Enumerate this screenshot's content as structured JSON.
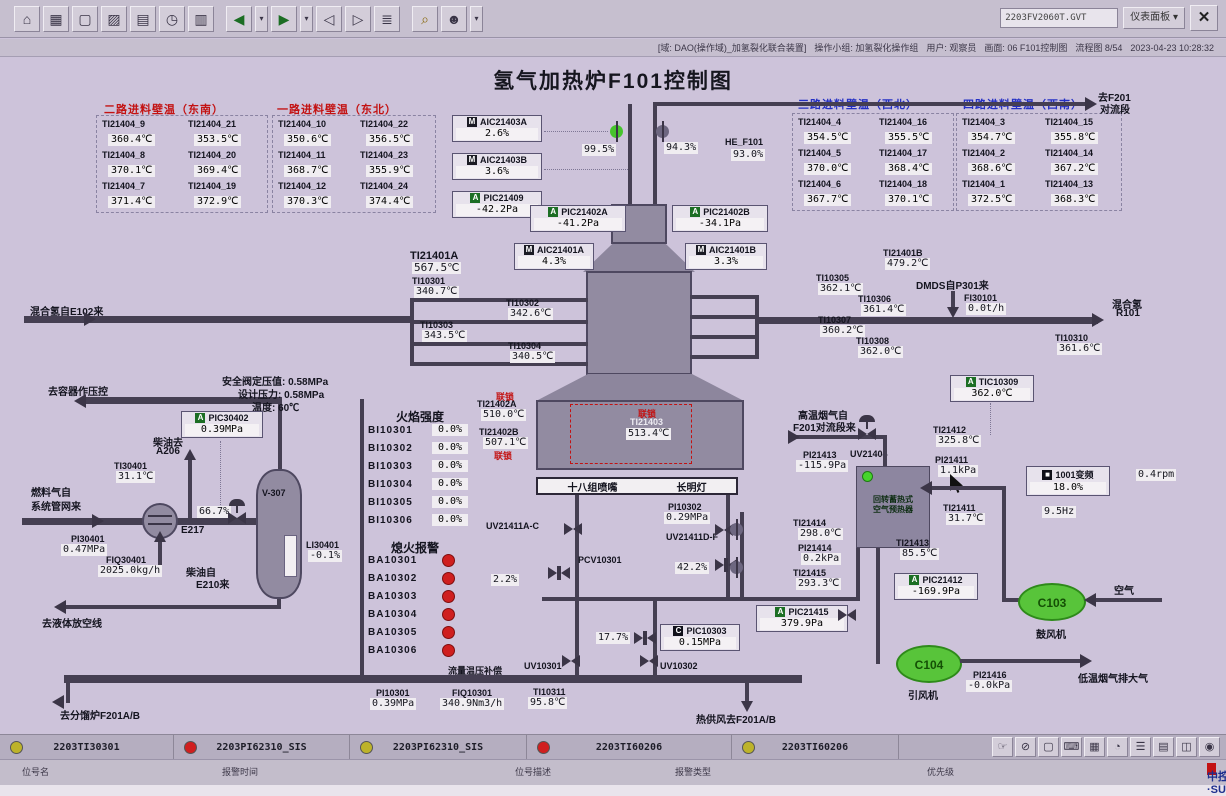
{
  "window": {
    "doc_selector": "2203FV2060T.GVT",
    "panel_button": "仪表面板 ▾",
    "status": {
      "domain": "[域: DAO(操作域)_加氢裂化联合装置]",
      "group": "操作小组: 加氢裂化操作组",
      "user": "用户: 观察员",
      "screen": "画面: 06 F101控制图",
      "flow": "流程图 8/54",
      "datetime": "2023-04-23 10:28:32"
    }
  },
  "title": "氢气加热炉F101控制图",
  "toolbar_icons": [
    {
      "name": "home",
      "glyph": "⌂"
    },
    {
      "name": "overview",
      "glyph": "▦"
    },
    {
      "name": "screen",
      "glyph": "▢"
    },
    {
      "name": "trend",
      "glyph": "▨"
    },
    {
      "name": "group",
      "glyph": "▤"
    },
    {
      "name": "history",
      "glyph": "◷"
    },
    {
      "name": "report",
      "glyph": "▥"
    },
    {
      "name": "back",
      "glyph": "◀"
    },
    {
      "name": "back-menu",
      "glyph": "▾"
    },
    {
      "name": "forward",
      "glyph": "▶"
    },
    {
      "name": "forward-menu",
      "glyph": "▾"
    },
    {
      "name": "page-prev",
      "glyph": "◁"
    },
    {
      "name": "page-next",
      "glyph": "▷"
    },
    {
      "name": "book",
      "glyph": "≣"
    },
    {
      "name": "search",
      "glyph": "⌕"
    },
    {
      "name": "user",
      "glyph": "☻"
    },
    {
      "name": "user-menu",
      "glyph": "▾"
    }
  ],
  "wall_panels": [
    {
      "title": "二路进料壁温（东南）",
      "items": [
        {
          "t": "TI21404_9",
          "v": "360.4℃"
        },
        {
          "t": "TI21404_21",
          "v": "353.5℃"
        },
        {
          "t": "TI21404_8",
          "v": "370.1℃"
        },
        {
          "t": "TI21404_20",
          "v": "369.4℃"
        },
        {
          "t": "TI21404_7",
          "v": "371.4℃"
        },
        {
          "t": "TI21404_19",
          "v": "372.9℃"
        }
      ]
    },
    {
      "title": "一路进料壁温（东北）",
      "items": [
        {
          "t": "TI21404_10",
          "v": "350.6℃"
        },
        {
          "t": "TI21404_22",
          "v": "356.5℃"
        },
        {
          "t": "TI21404_11",
          "v": "368.7℃"
        },
        {
          "t": "TI21404_23",
          "v": "355.9℃"
        },
        {
          "t": "TI21404_12",
          "v": "370.3℃"
        },
        {
          "t": "TI21404_24",
          "v": "374.4℃"
        }
      ]
    },
    {
      "title": "三路进料壁温（西北）",
      "items": [
        {
          "t": "TI21404_4",
          "v": "354.5℃"
        },
        {
          "t": "TI21404_16",
          "v": "355.5℃"
        },
        {
          "t": "TI21404_5",
          "v": "370.0℃"
        },
        {
          "t": "TI21404_17",
          "v": "368.4℃"
        },
        {
          "t": "TI21404_6",
          "v": "367.7℃"
        },
        {
          "t": "TI21404_18",
          "v": "370.1℃"
        }
      ]
    },
    {
      "title": "四路进料壁温（西南）",
      "items": [
        {
          "t": "TI21404_3",
          "v": "354.7℃"
        },
        {
          "t": "TI21404_15",
          "v": "355.8℃"
        },
        {
          "t": "TI21404_2",
          "v": "368.6℃"
        },
        {
          "t": "TI21404_14",
          "v": "367.2℃"
        },
        {
          "t": "TI21404_1",
          "v": "372.5℃"
        },
        {
          "t": "TI21404_13",
          "v": "368.3℃"
        }
      ]
    }
  ],
  "inst": {
    "AIC21403A": {
      "b": "M",
      "t": "AIC21403A",
      "v": "2.6%"
    },
    "AIC21403B": {
      "b": "M",
      "t": "AIC21403B",
      "v": "3.6%"
    },
    "PIC21409": {
      "b": "A",
      "t": "PIC21409",
      "v": "-42.2Pa"
    },
    "PIC21402A": {
      "b": "A",
      "t": "PIC21402A",
      "v": "-41.2Pa"
    },
    "PIC21402B": {
      "b": "A",
      "t": "PIC21402B",
      "v": "-34.1Pa"
    },
    "AIC21401A": {
      "b": "M",
      "t": "AIC21401A",
      "v": "4.3%"
    },
    "AIC21401B": {
      "b": "M",
      "t": "AIC21401B",
      "v": "3.3%"
    },
    "HE_F101": {
      "t": "HE_F101",
      "v": "93.0%"
    },
    "V995": {
      "v": "99.5%"
    },
    "V943": {
      "v": "94.3%"
    },
    "TI21401A": {
      "t": "TI21401A",
      "v": "567.5℃"
    },
    "TI21401B": {
      "t": "TI21401B",
      "v": "479.2℃"
    },
    "TI10301": {
      "t": "TI10301",
      "v": "340.7℃"
    },
    "TI10302": {
      "t": "TI10302",
      "v": "342.6℃"
    },
    "TI10303": {
      "t": "TI10303",
      "v": "343.5℃"
    },
    "TI10304": {
      "t": "TI10304",
      "v": "340.5℃"
    },
    "TI10305": {
      "t": "TI10305",
      "v": "362.1℃"
    },
    "TI10306": {
      "t": "TI10306",
      "v": "361.4℃"
    },
    "TI10307": {
      "t": "TI10307",
      "v": "360.2℃"
    },
    "TI10308": {
      "t": "TI10308",
      "v": "362.0℃"
    },
    "TI10310": {
      "t": "TI10310",
      "v": "361.6℃"
    },
    "FI30101": {
      "t": "FI30101",
      "v": "0.0t/h"
    },
    "TI21402A": {
      "t": "TI21402A",
      "v": "510.0℃"
    },
    "TI21402B": {
      "t": "TI21402B",
      "v": "507.1℃"
    },
    "TI21403": {
      "t": "TI21403",
      "v": "513.4℃"
    },
    "PIC30402": {
      "b": "A",
      "t": "PIC30402",
      "v": "0.39MPa"
    },
    "TI30401": {
      "t": "TI30401",
      "v": "31.1℃"
    },
    "PI30401": {
      "t": "PI30401",
      "v": "0.47MPa"
    },
    "FIQ30401": {
      "t": "FIQ30401",
      "v": "2025.0kg/h"
    },
    "LI30401": {
      "t": "LI30401",
      "v": "-0.1%"
    },
    "V667": {
      "v": "66.7%"
    },
    "PI10302": {
      "t": "PI10302",
      "v": "0.29MPa"
    },
    "PCV10301": {
      "t": "PCV10301"
    },
    "UV21411AC": {
      "t": "UV21411A-C"
    },
    "UV21411DF": {
      "t": "UV21411D-F"
    },
    "UV10301": {
      "t": "UV10301"
    },
    "UV10302": {
      "t": "UV10302"
    },
    "UV21404": {
      "t": "UV21404"
    },
    "V22": {
      "v": "2.2%"
    },
    "V422": {
      "v": "42.2%"
    },
    "V177": {
      "v": "17.7%"
    },
    "PIC10303": {
      "b": "C",
      "t": "PIC10303",
      "v": "0.15MPa"
    },
    "PI10301": {
      "t": "PI10301",
      "v": "0.39MPa"
    },
    "FIQ10301": {
      "t": "FIQ10301",
      "v": "340.9Nm3/h"
    },
    "TI10311": {
      "t": "TI10311",
      "v": "95.8℃"
    },
    "TIC10309": {
      "b": "A",
      "t": "TIC10309",
      "v": "362.0℃"
    },
    "TI21412": {
      "t": "TI21412",
      "v": "325.8℃"
    },
    "PI21413": {
      "t": "PI21413",
      "v": "-115.9Pa"
    },
    "PI21411": {
      "t": "PI21411",
      "v": "1.1kPa"
    },
    "VFD": {
      "t": "1001变频",
      "v": "18.0%",
      "hz": "9.5Hz",
      "rpm": "0.4rpm"
    },
    "TI21411": {
      "t": "TI21411",
      "v": "31.7℃"
    },
    "TI21413": {
      "t": "TI21413",
      "v": "85.5℃"
    },
    "PIC21412": {
      "b": "A",
      "t": "PIC21412",
      "v": "-169.9Pa"
    },
    "TI21414": {
      "t": "TI21414",
      "v": "298.0℃"
    },
    "PI21414": {
      "t": "PI21414",
      "v": "0.2kPa"
    },
    "TI21415": {
      "t": "TI21415",
      "v": "293.3℃"
    },
    "PIC21415": {
      "b": "A",
      "t": "PIC21415",
      "v": "379.9Pa"
    },
    "PI21416": {
      "t": "PI21416",
      "v": "-0.0kPa"
    }
  },
  "flame": {
    "title": "火焰强度",
    "rows": [
      {
        "t": "BI10301",
        "v": "0.0%"
      },
      {
        "t": "BI10302",
        "v": "0.0%"
      },
      {
        "t": "BI10303",
        "v": "0.0%"
      },
      {
        "t": "BI10304",
        "v": "0.0%"
      },
      {
        "t": "BI10305",
        "v": "0.0%"
      },
      {
        "t": "BI10306",
        "v": "0.0%"
      }
    ]
  },
  "flameout": {
    "title": "熄火报警",
    "rows": [
      {
        "t": "BA10301"
      },
      {
        "t": "BA10302"
      },
      {
        "t": "BA10303"
      },
      {
        "t": "BA10304"
      },
      {
        "t": "BA10305"
      },
      {
        "t": "BA10306"
      }
    ]
  },
  "labels": {
    "to_f201_1": "去F201",
    "to_f201_2": "对流段",
    "mix_in": "混合氢自E102来",
    "mix_out_1": "混合氢",
    "mix_out_2": "R101",
    "dmds": "DMDS自P301来",
    "to_vessel": "去容器作压控",
    "safety1": "安全阀定压值: 0.58MPa",
    "safety2": "设计压力: 0.58MPa",
    "safety3": "温度: 60℃",
    "diesel_to1": "柴油去",
    "diesel_to2": "A206",
    "fuel1": "燃料气自",
    "fuel2": "系统管网来",
    "diesel_from1": "柴油自",
    "diesel_from2": "E210来",
    "to_drain": "去液体放空线",
    "to_frac": "去分馏炉F201A/B",
    "comp": "流量温压补偿",
    "hot_air": "热供风去F201A/B",
    "hot_flue1": "高温烟气自",
    "hot_flue2": "F201对流段来",
    "air": "空气",
    "low_flue": "低温烟气排大气",
    "interlock": "联锁",
    "burner_left": "十八组喷嘴",
    "burner_right": "长明灯",
    "v307": "V-307",
    "e217": "E217",
    "c103": "C103",
    "c104": "C104",
    "blower": "鼓风机",
    "idfan": "引风机",
    "preheater1": "回转蓄热式",
    "preheater2": "空气预热器"
  },
  "alarm_bar": {
    "cells": [
      {
        "color": "#bdb32a",
        "tag": "2203TI30301"
      },
      {
        "color": "#d01f1f",
        "tag": "2203PI62310_SIS"
      },
      {
        "color": "#bdb32a",
        "tag": "2203PI62310_SIS"
      },
      {
        "color": "#d01f1f",
        "tag": "2203TI60206"
      },
      {
        "color": "#bdb32a",
        "tag": "2203TI60206"
      }
    ],
    "fields": [
      "位号名",
      "报警时间",
      "位号描述",
      "报警类型",
      "优先级"
    ],
    "logo": "中控·SUPCON"
  },
  "bottom_icons": [
    {
      "name": "hand",
      "glyph": "☞"
    },
    {
      "name": "disable",
      "glyph": "⊘"
    },
    {
      "name": "monitor",
      "glyph": "▢"
    },
    {
      "name": "keyboard",
      "glyph": "⌨"
    },
    {
      "name": "grid",
      "glyph": "▦"
    },
    {
      "name": "clock",
      "glyph": "◔"
    },
    {
      "name": "list",
      "glyph": "☰"
    },
    {
      "name": "report",
      "glyph": "▤"
    },
    {
      "name": "window",
      "glyph": "◫"
    },
    {
      "name": "target",
      "glyph": "◉"
    }
  ]
}
